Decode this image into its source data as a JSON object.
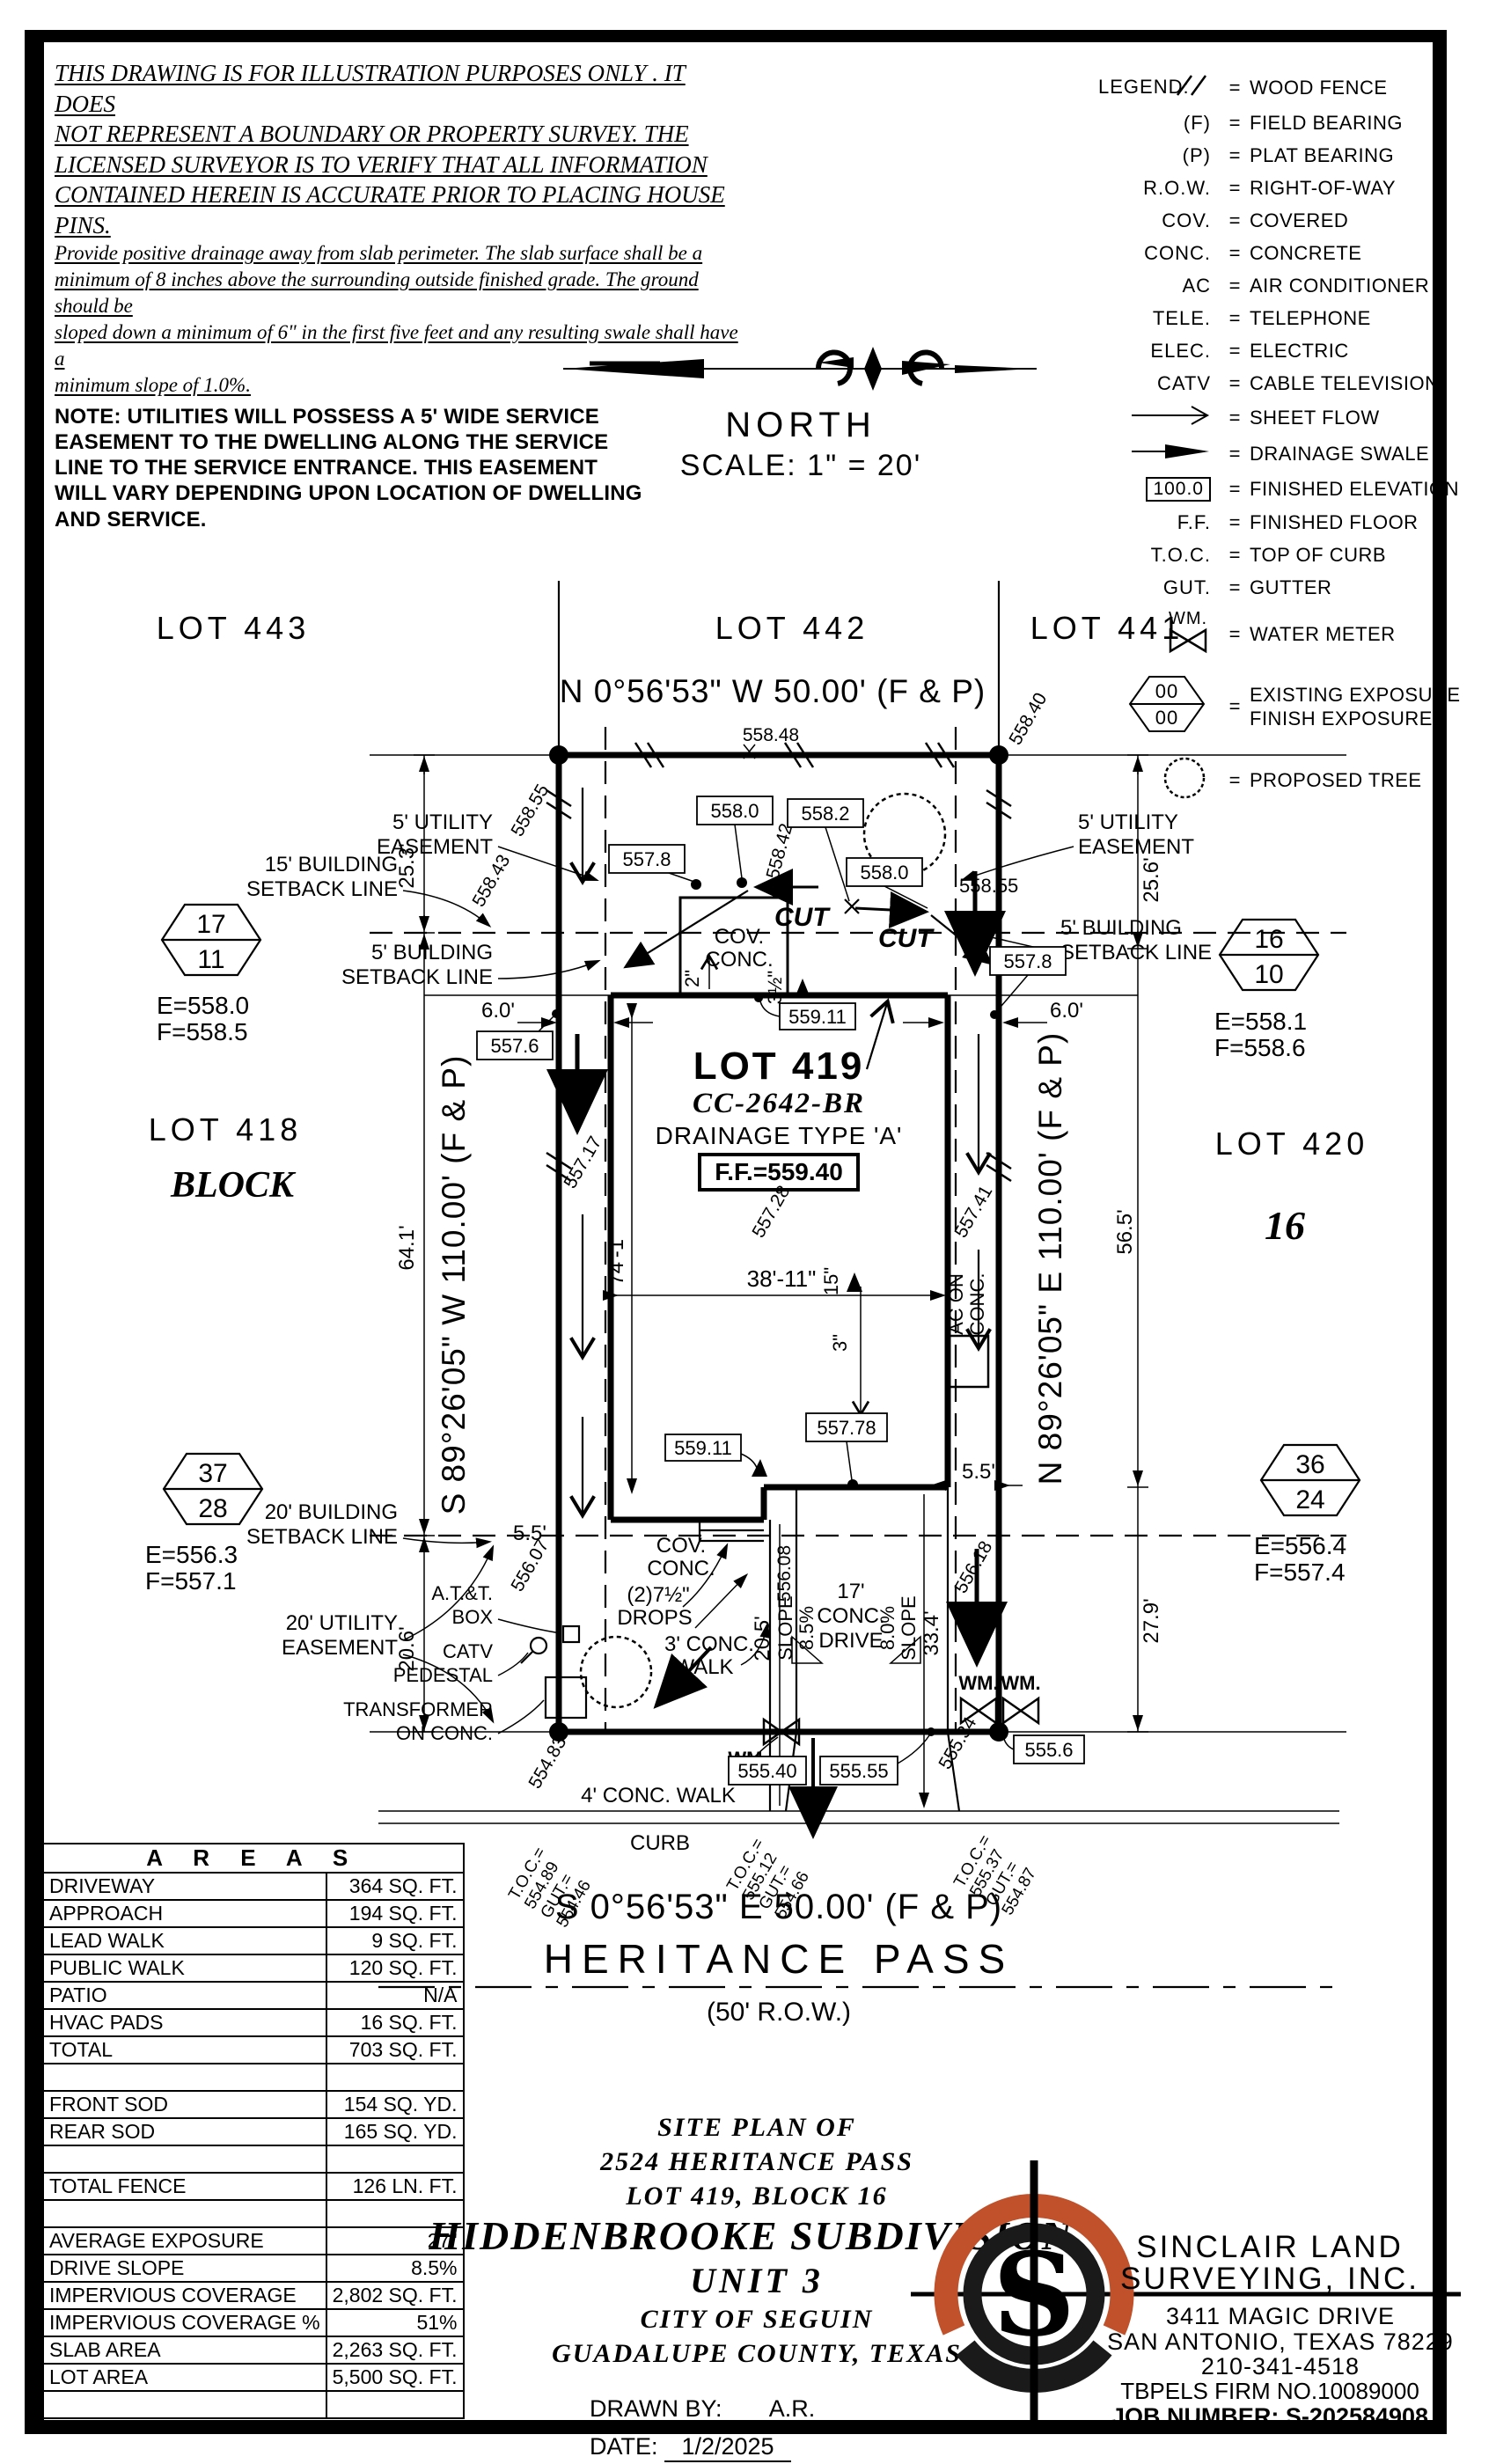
{
  "disclaimer": {
    "para1": [
      "THIS DRAWING IS FOR ILLUSTRATION PURPOSES ONLY . IT DOES",
      "NOT REPRESENT A BOUNDARY OR PROPERTY SURVEY. THE",
      "LICENSED SURVEYOR IS TO VERIFY THAT ALL INFORMATION",
      "CONTAINED HEREIN IS ACCURATE PRIOR TO PLACING HOUSE PINS."
    ],
    "para2": [
      "Provide positive drainage away from slab perimeter. The slab surface shall be a",
      "minimum of 8 inches above the surrounding outside finished grade. The ground should be",
      "sloped down a minimum of 6\" in the first five feet and any resulting swale shall have a",
      "minimum slope of 1.0%."
    ],
    "note": [
      "NOTE:  UTILITIES  WILL  POSSESS  A  5'  WIDE  SERVICE",
      "EASEMENT  TO  THE  DWELLING  ALONG  THE  SERVICE",
      "LINE  TO  THE  SERVICE  ENTRANCE.  THIS  EASEMENT",
      "WILL  VARY  DEPENDING  UPON  LOCATION  OF  DWELLING",
      "AND  SERVICE."
    ]
  },
  "north": {
    "label": "NORTH",
    "scale": "SCALE:  1\"  =  20'"
  },
  "legend": {
    "title": "LEGEND:",
    "eq": "=",
    "rows": [
      {
        "abbr": "",
        "desc": "WOOD FENCE"
      },
      {
        "abbr": "(F)",
        "desc": "FIELD BEARING"
      },
      {
        "abbr": "(P)",
        "desc": "PLAT BEARING"
      },
      {
        "abbr": "R.O.W.",
        "desc": "RIGHT-OF-WAY"
      },
      {
        "abbr": "COV.",
        "desc": "COVERED"
      },
      {
        "abbr": "CONC.",
        "desc": "CONCRETE"
      },
      {
        "abbr": "AC",
        "desc": "AIR CONDITIONER"
      },
      {
        "abbr": "TELE.",
        "desc": "TELEPHONE"
      },
      {
        "abbr": "ELEC.",
        "desc": "ELECTRIC"
      },
      {
        "abbr": "CATV",
        "desc": "CABLE TELEVISION"
      },
      {
        "abbr": "",
        "desc": "SHEET FLOW"
      },
      {
        "abbr": "",
        "desc": "DRAINAGE SWALE"
      },
      {
        "abbr": "100.0",
        "desc": "FINISHED ELEVATION"
      },
      {
        "abbr": "F.F.",
        "desc": "FINISHED FLOOR"
      },
      {
        "abbr": "T.O.C.",
        "desc": "TOP OF CURB"
      },
      {
        "abbr": "GUT.",
        "desc": "GUTTER"
      },
      {
        "abbr": "WM.",
        "desc": "WATER METER"
      },
      {
        "abbr": "00",
        "abbr2": "00",
        "desc": "EXISTING EXPOSURE",
        "desc2": "FINISH EXPOSURE"
      },
      {
        "abbr": "",
        "desc": "PROPOSED TREE"
      }
    ]
  },
  "plat": {
    "lot443": "LOT 443",
    "lot442": "LOT 442",
    "lot441": "LOT 441",
    "bearing_top": "N 0°56'53\" W 50.00' (F & P)",
    "e55848": "558.48",
    "e55840": "558.40",
    "e55855a": "558.55",
    "e55843": "558.43",
    "b5578a": "557.8",
    "b5580a": "558.0",
    "e55842": "558.42",
    "b5582": "558.2",
    "b5580b": "558.0",
    "e55855b": "558.55",
    "cut": "CUT",
    "ue5_1": "5' UTILITY",
    "ue5_2": "EASEMENT",
    "bsl15_1": "15' BUILDING",
    "bsl15_2": "SETBACK LINE",
    "bsl5_1": "5' BUILDING",
    "bsl5_2": "SETBACK LINE",
    "bsl20_1": "20' BUILDING",
    "bsl20_2": "SETBACK LINE",
    "ue20_1": "20' UTILITY",
    "ue20_2": "EASEMENT",
    "d253": "25.3'",
    "d256": "25.6'",
    "d641": "64.1'",
    "d565": "56.5'",
    "d206": "20.6'",
    "d279": "27.9'",
    "d60": "6.0'",
    "b5576": "557.6",
    "b5578b": "557.8",
    "hex17": "17",
    "hex11": "11",
    "hexL_e": "E=558.0",
    "hexL_f": "F=558.5",
    "hex16": "16",
    "hex10": "10",
    "hexR_e": "E=558.1",
    "hexR_f": "F=558.6",
    "hex37": "37",
    "hex28": "28",
    "hexBL_e": "E=556.3",
    "hexBL_f": "F=557.1",
    "hex36": "36",
    "hex24": "24",
    "hexBR_e": "E=556.4",
    "hexBR_f": "F=557.4",
    "lot418": "LOT 418",
    "block": "BLOCK",
    "lot420": "LOT 420",
    "block16": "16",
    "bearing_w": "S 89°26'05\" W 110.00' (F & P)",
    "bearing_e": "N 89°26'05\" E 110.00' (F & P)",
    "lot419": "LOT 419",
    "cc": "CC-2642-BR",
    "drainage": "DRAINAGE TYPE 'A'",
    "ff": "F.F.=559.40",
    "covconc_a": "COV.",
    "covconc_b": "CONC.",
    "d2in": "2\"",
    "d35in": "3½\"",
    "b55911": "559.11",
    "d741": "74'-1\"",
    "e55717": "557.17",
    "e55728": "557.28",
    "d15in": "15\"",
    "e55741": "557.41",
    "acon1": "AC ON",
    "acon2": "CONC.",
    "d3811": "38'-11\"",
    "d3in": "3\"",
    "b55778": "557.78",
    "d55": "5.5'",
    "e55608": "556.08",
    "e55607": "556.07",
    "e55618": "556.18",
    "drops1": "(2)7½\"",
    "drops2": "DROPS",
    "walk3a": "3' CONC.",
    "walk3b": "WALK",
    "slope_l": "SLOPE",
    "slope85": "8.5%",
    "drive17a": "17'",
    "drive17b": "CONC.",
    "drive17c": "DRIVE",
    "slope80": "8.0%",
    "d205": "20.5'",
    "d334": "33.4'",
    "att1": "A.T.&T.",
    "att2": "BOX",
    "catv1": "CATV",
    "catv2": "PEDESTAL",
    "trans1": "TRANSFORMER",
    "trans2": "ON CONC.",
    "wm": "WM.",
    "e55483": "554.83",
    "e55534": "555.34",
    "b5556": "555.6",
    "b55540": "555.40",
    "b55555": "555.55",
    "walk4": "4' CONC. WALK",
    "curb": "CURB",
    "toc1": [
      "T.O.C.=",
      "554.89",
      "GUT.=",
      "554.46"
    ],
    "toc2": [
      "T.O.C.=",
      "555.12",
      "GUT.=",
      "554.66"
    ],
    "toc3": [
      "T.O.C.=",
      "555.37",
      "GUT.=",
      "554.87"
    ],
    "bearing_bottom": "S 0°56'53\" E 50.00' (F & P)",
    "street": "HERITANCE PASS",
    "row50": "(50' R.O.W.)"
  },
  "areas": {
    "title": "A R E A S",
    "rows": [
      {
        "l": "DRIVEWAY",
        "v": "364 SQ. FT."
      },
      {
        "l": "APPROACH",
        "v": "194 SQ. FT."
      },
      {
        "l": "LEAD WALK",
        "v": "9 SQ. FT."
      },
      {
        "l": "PUBLIC WALK",
        "v": "120 SQ. FT."
      },
      {
        "l": "PATIO",
        "v": "N/A"
      },
      {
        "l": "HVAC PADS",
        "v": "16 SQ. FT."
      },
      {
        "l": "TOTAL",
        "v": "703 SQ. FT."
      },
      {
        "l": "",
        "v": ""
      },
      {
        "l": "FRONT SOD",
        "v": "154 SQ. YD."
      },
      {
        "l": "REAR SOD",
        "v": "165 SQ. YD."
      },
      {
        "l": "",
        "v": ""
      },
      {
        "l": "TOTAL FENCE",
        "v": "126 LN. FT."
      },
      {
        "l": "",
        "v": ""
      },
      {
        "l": "AVERAGE EXPOSURE",
        "v": "27\""
      },
      {
        "l": "DRIVE SLOPE",
        "v": "8.5%"
      },
      {
        "l": "IMPERVIOUS COVERAGE",
        "v": "2,802 SQ. FT."
      },
      {
        "l": "IMPERVIOUS COVERAGE %",
        "v": "51%"
      },
      {
        "l": "SLAB AREA",
        "v": "2,263 SQ. FT."
      },
      {
        "l": "LOT AREA",
        "v": "5,500 SQ. FT."
      },
      {
        "l": "",
        "v": ""
      }
    ]
  },
  "title_block": {
    "l1": "SITE PLAN OF",
    "l2": "2524 HERITANCE PASS",
    "l3": "LOT 419, BLOCK 16",
    "l4": "HIDDENBROOKE SUBDIVISION,",
    "l5": "UNIT 3",
    "l6": "CITY OF SEGUIN",
    "l7": "GUADALUPE COUNTY, TEXAS",
    "drawn_label": "DRAWN BY:",
    "drawn": "A.R.",
    "date_label": "DATE:",
    "date": "1/2/2025"
  },
  "firm": {
    "name1": "SINCLAIR LAND",
    "name2": "SURVEYING, INC.",
    "addr1": "3411 MAGIC DRIVE",
    "addr2": "SAN ANTONIO, TEXAS 78229",
    "phone": "210-341-4518",
    "firmno": "TBPELS FIRM NO.10089000",
    "job": "JOB NUMBER: S-202584908",
    "logo_s": "S"
  },
  "colors": {
    "accent": "#c0512a",
    "ink": "#000000"
  }
}
